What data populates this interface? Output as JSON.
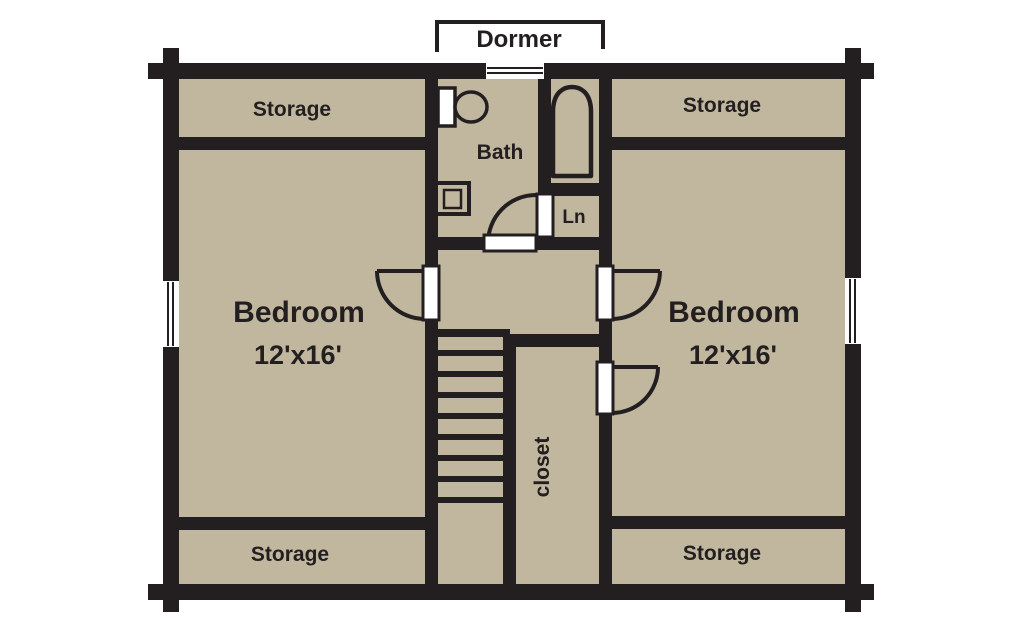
{
  "plan_title": "Second floor log-home floor plan",
  "colors": {
    "floor": "#c1b79e",
    "wall": "#231f20",
    "opening": "#ffffff"
  },
  "labels": {
    "dormer": "Dormer",
    "storage_top_left": "Storage",
    "storage_top_right": "Storage",
    "storage_bottom_left": "Storage",
    "storage_bottom_right": "Storage",
    "bath": "Bath",
    "linen": "Ln",
    "closet": "closet",
    "bedroom_left": {
      "name": "Bedroom",
      "size": "12'x16'"
    },
    "bedroom_right": {
      "name": "Bedroom",
      "size": "12'x16'"
    }
  },
  "features": {
    "fixtures": [
      "toilet",
      "bathtub",
      "sink"
    ],
    "stairs_treads": 8,
    "windows": 3,
    "doors": 5
  }
}
